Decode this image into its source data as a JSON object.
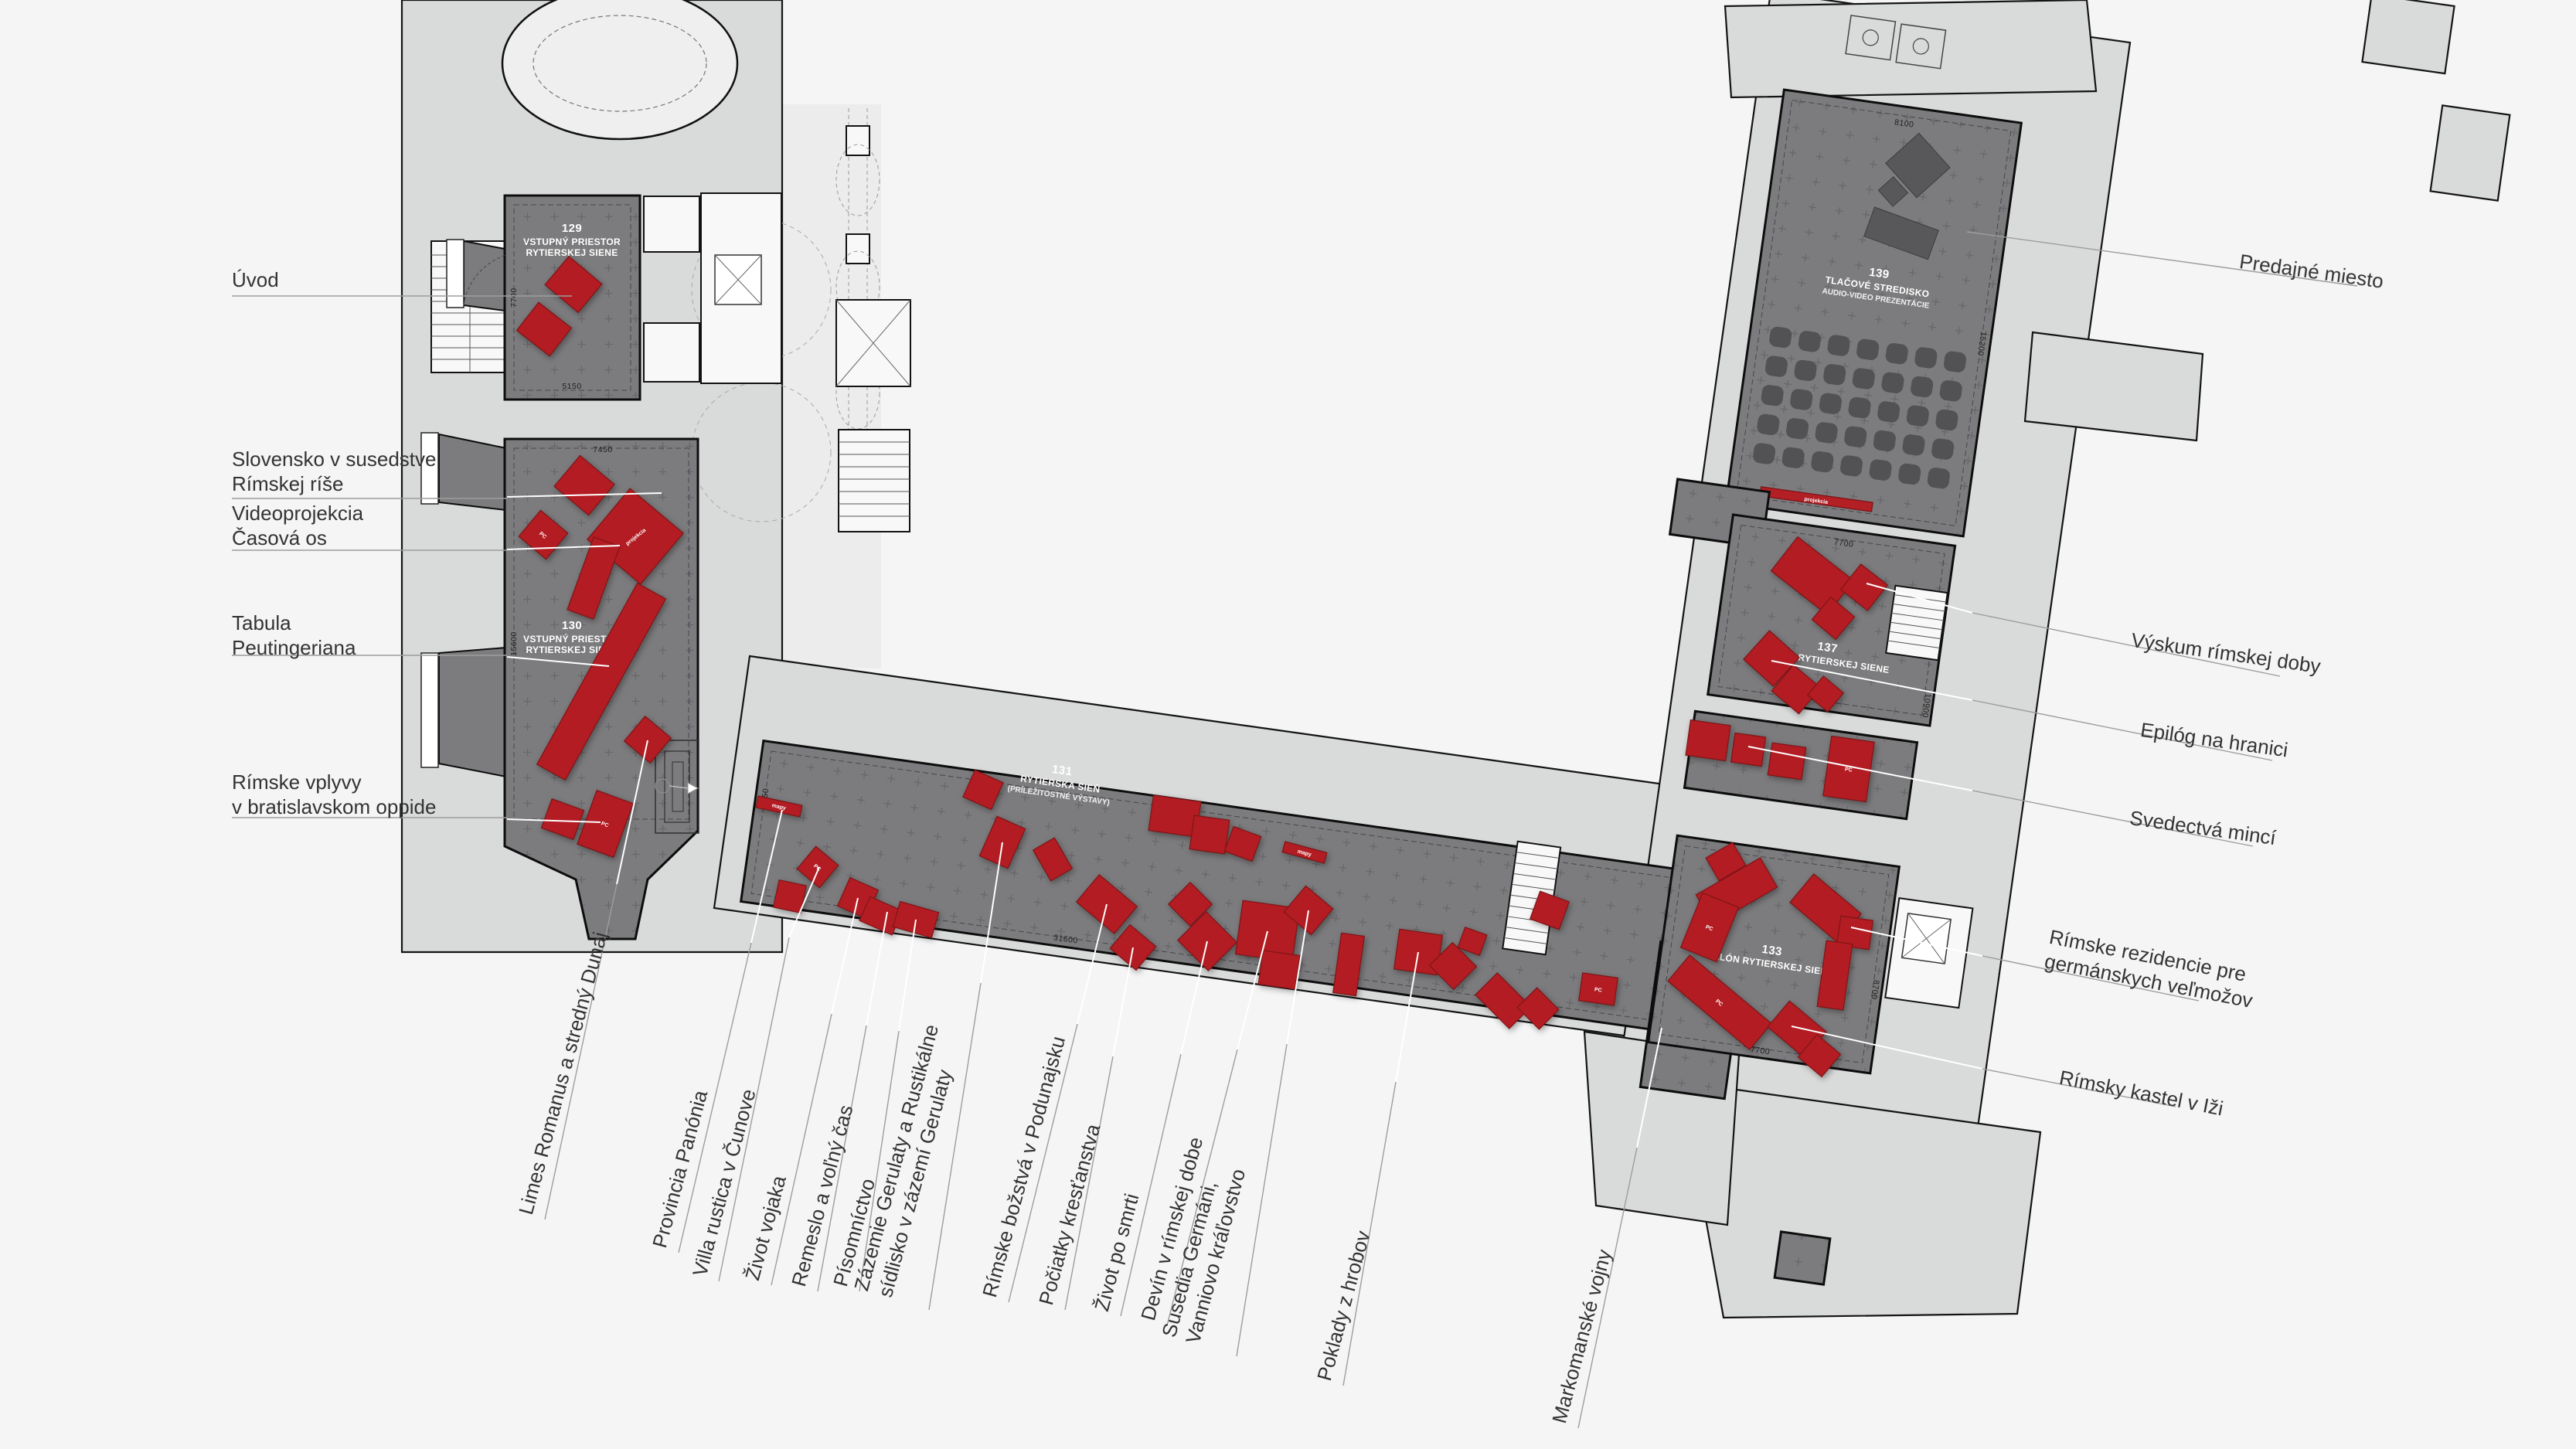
{
  "rooms": {
    "r129": {
      "num": "129",
      "line1": "VSTUPNÝ PRIESTOR",
      "line2": "RYTIERSKEJ SIENE",
      "dim_w": "5150",
      "dim_h": "7700"
    },
    "r130": {
      "num": "130",
      "line1": "VSTUPNÝ PRIESTOR",
      "line2": "RYTIERSKEJ SIENE",
      "dim_w": "7450",
      "dim_h": "15600"
    },
    "r131": {
      "num": "131",
      "line1": "RYTIERSKA SIEŇ",
      "line2": "(PRÍLEŽITOSTNÉ VÝSTAVY)",
      "dim_w": "31600",
      "dim_left": "7250"
    },
    "r139": {
      "num": "139",
      "line1": "TLAČOVÉ STREDISKO",
      "line2": "AUDIO-VIDEO PREZENTÁCIE",
      "dim_w": "8100",
      "dim_h": "15200"
    },
    "r137": {
      "num": "137",
      "line1": "SALÓN RYTIERSKEJ SIENE",
      "dim_w": "7700",
      "dim_h": "10900"
    },
    "r133": {
      "num": "133",
      "line1": "SALÓN RYTIERSKEJ SIENE",
      "dim_w": "7700",
      "dim_h": "8700"
    }
  },
  "furn": {
    "pc": "PC",
    "mapy": "mapy",
    "projekcia": "projekcia"
  },
  "labels": {
    "left": [
      "Úvod",
      "Slovensko v susedstve\nRímskej ríše",
      "Videoprojekcia\nČasová os",
      "Tabula\nPeutingeriana",
      "Rímske vplyvy\nv bratislavskom oppide"
    ],
    "right": [
      "Predajné miesto",
      "Výskum rímskej doby",
      "Epilóg na hranici",
      "Svedectvá mincí",
      "Rímske rezidencie pre\ngermánskych veľmožov",
      "Rímsky kastel v Iži"
    ],
    "bottom": [
      "Limes Romanus a stredný Dunaj",
      "Provincia Panónia",
      "Villa rustica v Čunove",
      "Život vojaka",
      "Remeslo a voľný čas",
      "Písomníctvo",
      "Zázemie Gerulaty a Rustikálne\nsídlisko v zázemí Gerulaty",
      "Rímske božstvá v Podunajsku",
      "Počiatky kresťanstva",
      "Život po smrti",
      "Devín v rímskej dobe",
      "Susedia Germáni,\nVanniovo kráľovstvo",
      "Poklady z hrobov",
      "Markomanské vojny"
    ]
  },
  "colors": {
    "accent_red": "#b21f24",
    "floor": "#7c7c7e",
    "building": "#d9dada",
    "background": "#f5f5f6"
  }
}
